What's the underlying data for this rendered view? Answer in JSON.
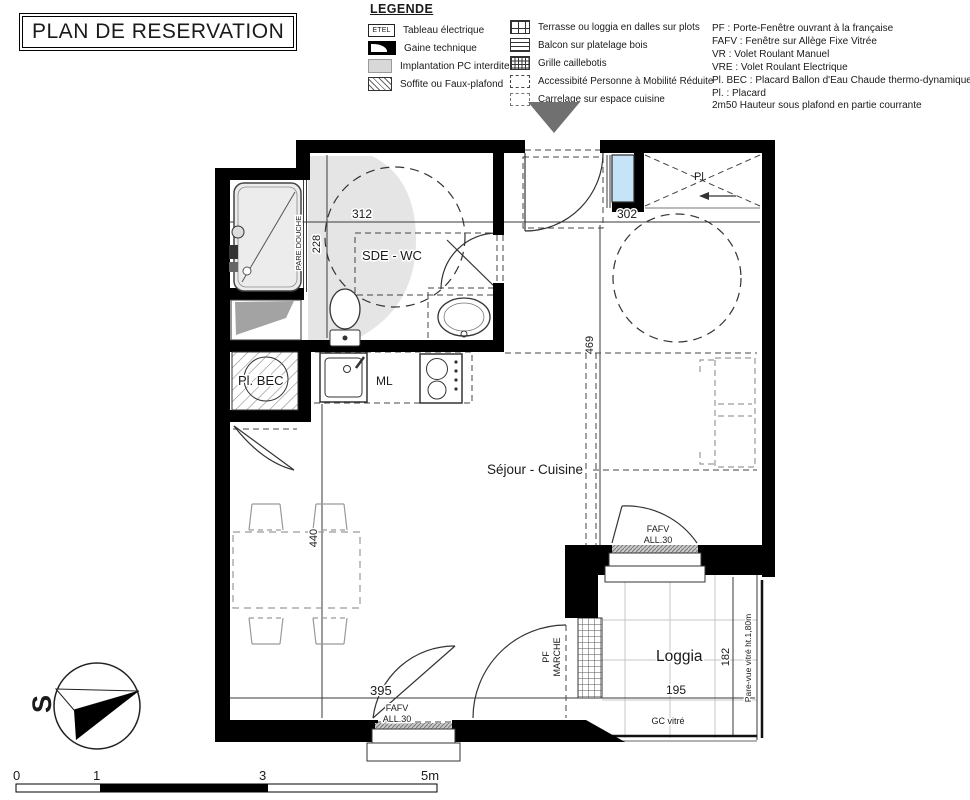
{
  "header": {
    "title": "PLAN DE RESERVATION"
  },
  "legend": {
    "heading": "LEGENDE",
    "col1": [
      {
        "icon": "etel-box",
        "badge": "ETEL",
        "label": "Tableau électrique"
      },
      {
        "icon": "gaine-technique",
        "label": "Gaine technique"
      },
      {
        "icon": "pc-interdit",
        "label": "Implantation PC interdite"
      },
      {
        "icon": "soffite-hatch",
        "label": "Soffite ou Faux-plafond"
      }
    ],
    "col2": [
      {
        "icon": "dalles-grid",
        "label": "Terrasse ou loggia en dalles sur plots"
      },
      {
        "icon": "platelage-lines",
        "label": "Balcon sur platelage bois"
      },
      {
        "icon": "caillebotis-grid",
        "label": "Grille caillebotis"
      },
      {
        "icon": "pmr-dash",
        "label": "Accessibité Personne à Mobilité Réduite"
      },
      {
        "icon": "carrelage-dash",
        "label": "Carrelage sur espace cuisine"
      }
    ],
    "abbreviations": [
      "PF : Porte-Fenêtre ouvrant à la française",
      "FAFV : Fenêtre sur Allège Fixe Vitrée",
      "VR : Volet Roulant Manuel",
      "VRE : Volet Roulant Electrique",
      "Pl. BEC : Placard Ballon d'Eau Chaude thermo-dynamique",
      "Pl. : Placard",
      "2m50 Hauteur sous plafond en partie courrante"
    ]
  },
  "plan": {
    "rooms": {
      "sde_wc": "SDE - WC",
      "sejour": "Séjour - Cuisine",
      "loggia": "Loggia",
      "pl": "Pl.",
      "pl_bec": "Pl. BEC"
    },
    "labels": {
      "ml": "ML",
      "pare_douche": "PARE DOUCHE",
      "fafv": "FAFV",
      "all30": "ALL.30",
      "pf": "PF",
      "marche": "MARCHE",
      "gc_vitre": "GC vitré",
      "pare_vue": "Pare-vue vitré ht.1,80m"
    },
    "dimensions": {
      "d312": "312",
      "d302": "302",
      "d228": "228",
      "d469": "469",
      "d440": "440",
      "d395": "395",
      "d195": "195",
      "d182": "182"
    }
  },
  "compass": {
    "letter": "S"
  },
  "scalebar": {
    "ticks": [
      "0",
      "1",
      "3",
      "5m"
    ]
  },
  "colors": {
    "wall_black": "#000000",
    "window_blue": "#c7e3f7",
    "zone_gray": "#e5e5e5",
    "entry_arrow_gray": "#707070"
  }
}
